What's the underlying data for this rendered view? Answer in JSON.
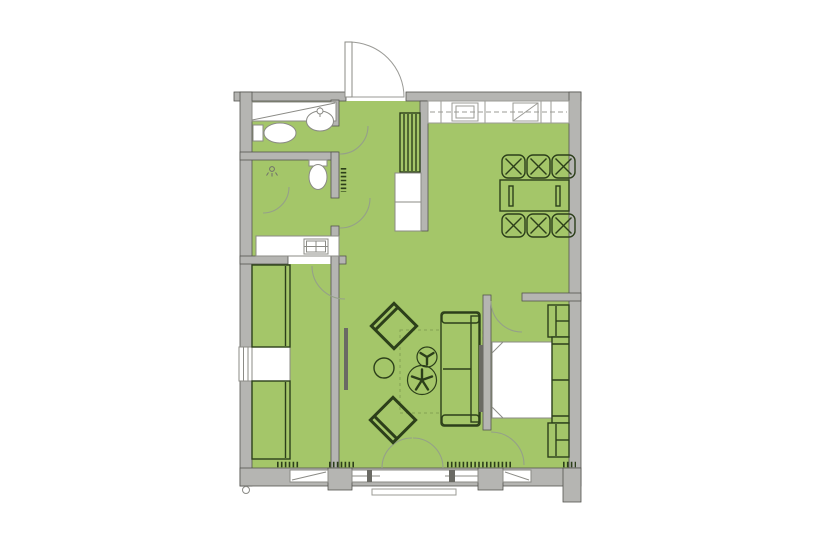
{
  "colors": {
    "background": "#ffffff",
    "room_fill": "#a4c669",
    "wall_fill": "#b5b5b2",
    "wall_stroke": "#54544f",
    "furniture_stroke": "#2c3f1a",
    "fixture_fill": "#ffffff",
    "fixture_stroke": "#8b8b86",
    "counter_stroke": "#9b9b96",
    "door_swing_stroke": "#95a089",
    "rug_dash_stroke": "#84a352",
    "panel_fill": "#6a6a64"
  },
  "plan": {
    "type": "apartment-floor-plan",
    "fixture_icons": [
      "entry-door-icon",
      "entry-wardrobe-icon",
      "toilet-icon",
      "washbasin-icon",
      "shower-head-icon",
      "shower-screen-icon",
      "washer-icon",
      "laundry-counter-icon",
      "hall-shelf-icon",
      "hall-cabinet-icon",
      "kitchen-counter-icon",
      "kitchen-sink-icon",
      "cooktop-icon",
      "dining-table-icon",
      "dining-chair-icon",
      "armchair-icon",
      "side-table-icon",
      "pedestal-table-icon",
      "sofa-icon",
      "rug-outline-icon",
      "tv-panel-icon",
      "double-bed-icon",
      "nightstand-icon",
      "closet-icon",
      "window-icon",
      "french-door-icon",
      "radiator-icon",
      "survey-marker-icon"
    ],
    "counts": {
      "dining_chairs": 6,
      "armchairs": 2,
      "toilets": 2,
      "nightstands": 2,
      "closets": 2,
      "windows": 4,
      "radiators": 5
    }
  }
}
